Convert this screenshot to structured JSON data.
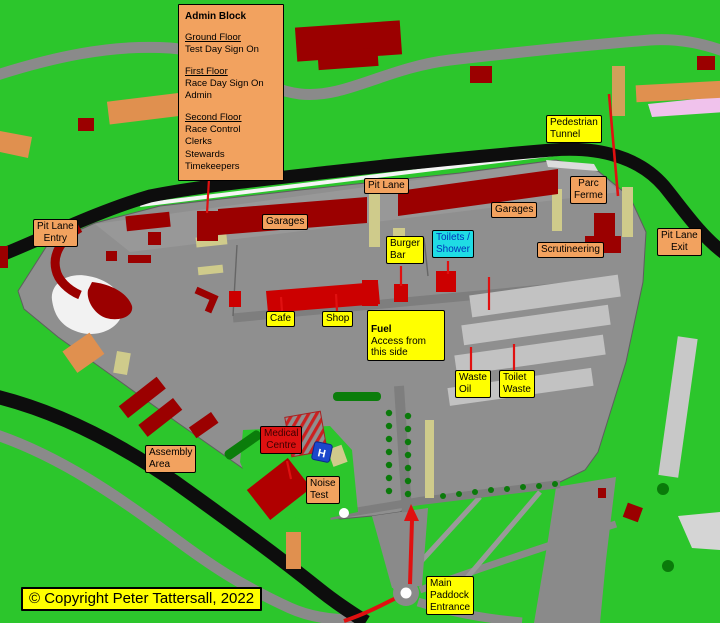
{
  "admin_block": {
    "title": "Admin Block",
    "sections": [
      {
        "heading": "Ground Floor",
        "items": [
          "Test Day Sign On"
        ]
      },
      {
        "heading": "First Floor",
        "items": [
          "Race Day Sign On",
          "Admin"
        ]
      },
      {
        "heading": "Second Floor",
        "items": [
          "Race Control",
          "Clerks",
          "Stewards",
          "Timekeepers"
        ]
      }
    ]
  },
  "labels": {
    "pit_lane": {
      "text": "Pit Lane"
    },
    "garages_left": {
      "text": "Garages"
    },
    "garages_right": {
      "text": "Garages"
    },
    "pit_lane_entry": {
      "text": "Pit Lane\nEntry"
    },
    "pedestrian_tunnel": {
      "text": "Pedestrian\nTunnel"
    },
    "parc_ferme": {
      "text": "Parc\nFerme"
    },
    "pit_lane_exit": {
      "text": "Pit Lane\nExit"
    },
    "scrutineering": {
      "text": "Scrutineering"
    },
    "burger_bar": {
      "text": "Burger\nBar"
    },
    "toilets_shower": {
      "text": "Toilets /\nShower"
    },
    "cafe": {
      "text": "Cafe"
    },
    "shop": {
      "text": "Shop"
    },
    "fuel": {
      "title": "Fuel",
      "text": "Access from\nthis side"
    },
    "waste_oil": {
      "text": "Waste\nOil"
    },
    "toilet_waste": {
      "text": "Toilet\nWaste"
    },
    "assembly_area": {
      "text": "Assembly\nArea"
    },
    "medical_centre": {
      "text": "Medical\nCentre"
    },
    "noise_test": {
      "text": "Noise\nTest"
    },
    "main_paddock_entrance": {
      "text": "Main\nPaddock\nEntrance"
    }
  },
  "helipad": {
    "letter": "H"
  },
  "copyright": {
    "text": "© Copyright Peter Tattersall, 2022"
  },
  "colors": {
    "grass": "#2CC62C",
    "road": "#8A8A8A",
    "paddock": "#8F8F8F",
    "track": "#0D0D0D",
    "building_dark_red": "#9B0000",
    "building_bright_red": "#CC0000",
    "building_tan": "#E0904F",
    "label_orange": "#F2A25F",
    "label_yellow": "#FFFF00",
    "label_cyan": "#1FDCE4",
    "label_cyan_text": "#0033BB",
    "label_red": "#DD1111",
    "pointer_red": "#E01010",
    "khaki": "#CFCB8B",
    "pink": "#F0C2EC",
    "helipad_blue": "#1C47CC",
    "tree_green": "#0A7A0A"
  }
}
